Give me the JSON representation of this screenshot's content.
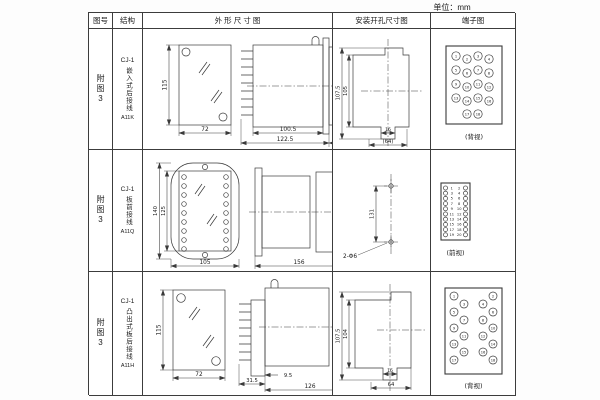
{
  "page": {
    "unit_label": "单位：mm"
  },
  "table_headers": {
    "figure": "图号",
    "structure": "结构",
    "outline": "外 形 尺 寸 图",
    "mounting": "安装开孔尺寸图",
    "terminal": "端子图"
  },
  "rows": [
    {
      "figure": "附图3",
      "model": "CJ-1",
      "structure": "嵌入式后接线",
      "code": "A11K",
      "dims": {
        "height": "115",
        "width": "72",
        "depth_body": "100.5",
        "depth_total": "122.5",
        "depth_rear": "35"
      },
      "mounting": {
        "outer_height": "107.5",
        "inner_height": "105",
        "notch": "16",
        "opening": "(64)"
      },
      "terminal_view": "(背视)",
      "terminals": [
        "1",
        "2",
        "3",
        "4",
        "5",
        "6",
        "7",
        "8",
        "9",
        "10",
        "11",
        "12",
        "13",
        "14",
        "15",
        "16",
        "17",
        "18"
      ]
    },
    {
      "figure": "附图3",
      "model": "CJ-1",
      "structure": "板前接线",
      "code": "A11Q",
      "dims": {
        "outer_height": "140",
        "inner_height": "125",
        "width": "105",
        "depth": "156",
        "rear_height": "115"
      },
      "mounting": {
        "hole_spacing": "131",
        "holes": "2-Φ6"
      },
      "terminal_view": "(前视)",
      "terminals_left": [
        "1",
        "3",
        "5",
        "7",
        "9",
        "11",
        "13",
        "15",
        "17",
        "19"
      ],
      "terminals_right": [
        "2",
        "4",
        "6",
        "8",
        "10",
        "12",
        "14",
        "16",
        "18",
        "20"
      ]
    },
    {
      "figure": "附图3",
      "model": "CJ-1",
      "structure": "凸出式板后接线",
      "code": "A11H",
      "dims": {
        "height": "115",
        "width": "72",
        "depth_front": "31.5",
        "depth_gap": "9.5",
        "depth_body": "126"
      },
      "mounting": {
        "outer_height": "107.5",
        "inner_height": "104",
        "notch": "16",
        "opening": "64"
      },
      "terminal_view": "(背视)",
      "terminals": [
        "1",
        "2",
        "3",
        "4",
        "5",
        "6",
        "7",
        "8",
        "9",
        "10",
        "11",
        "12",
        "13",
        "14",
        "15",
        "16",
        "17",
        "18"
      ]
    }
  ]
}
